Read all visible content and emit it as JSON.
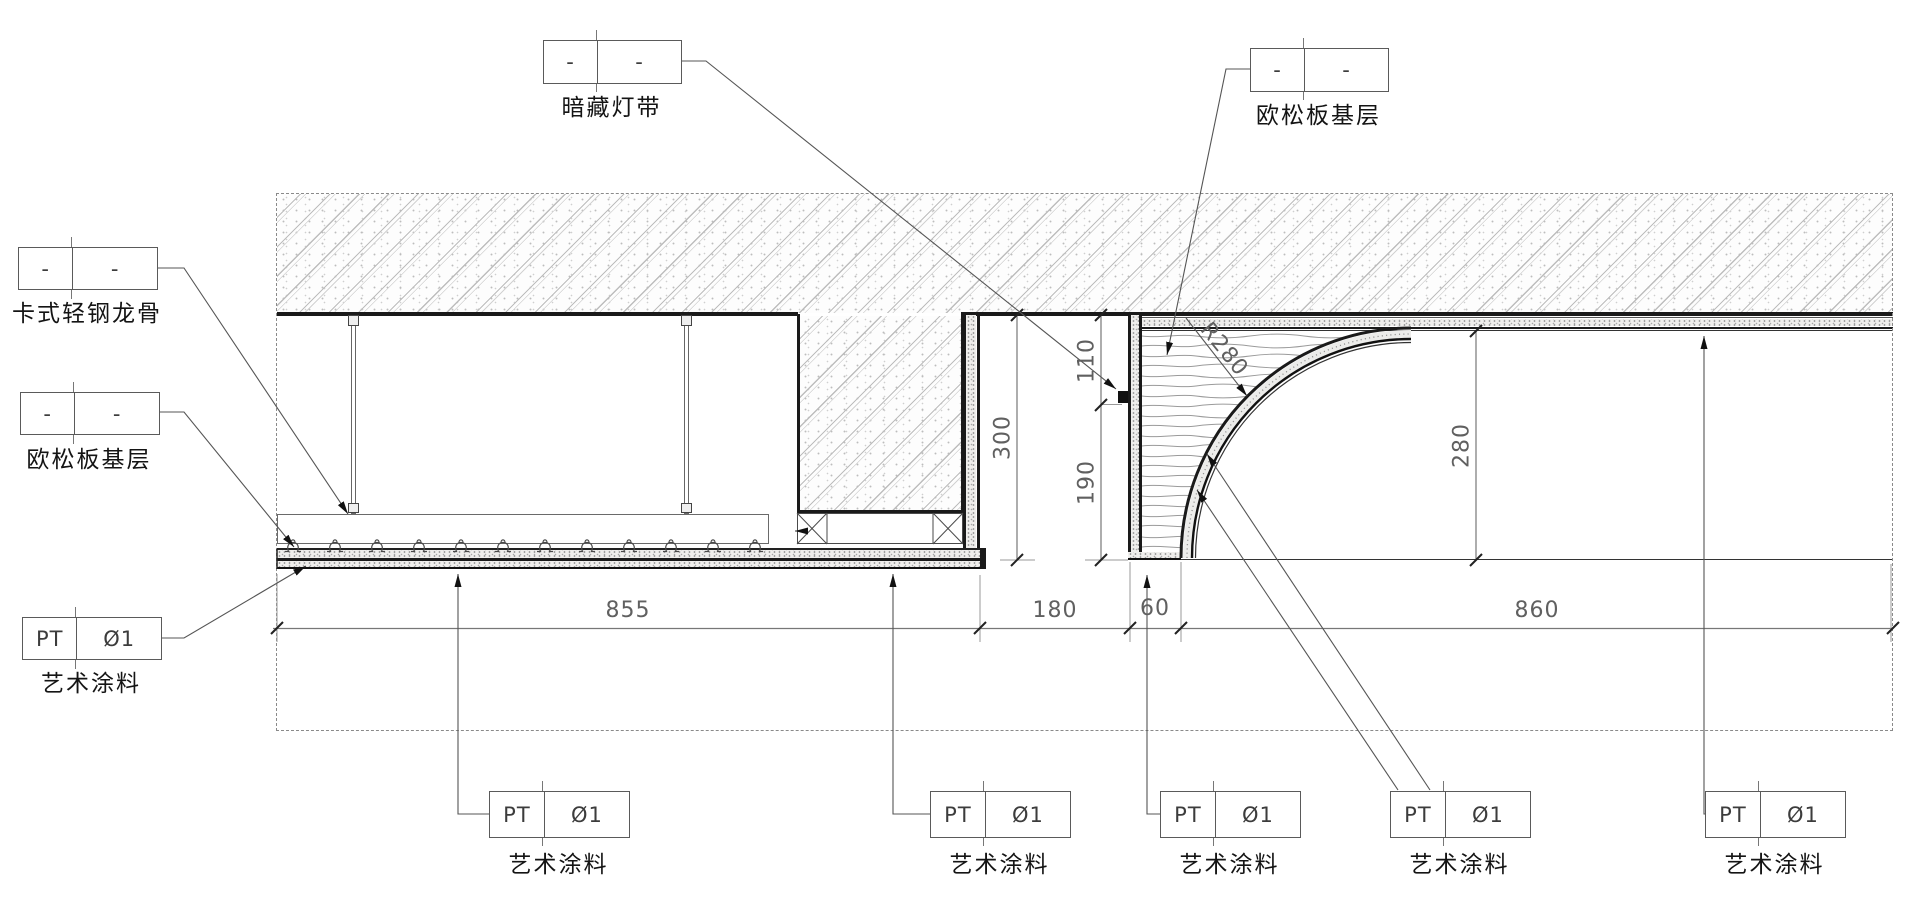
{
  "callouts": {
    "hidden_light": {
      "c1": "-",
      "c2": "-",
      "label": "暗藏灯带"
    },
    "osb_top": {
      "c1": "-",
      "c2": "-",
      "label": "欧松板基层"
    },
    "keel": {
      "c1": "-",
      "c2": "-",
      "label": "卡式轻钢龙骨"
    },
    "osb_left": {
      "c1": "-",
      "c2": "-",
      "label": "欧松板基层"
    },
    "paint_left": {
      "c1": "PT",
      "c2": "Ø1",
      "label": "艺术涂料"
    },
    "paint_bottom": [
      {
        "c1": "PT",
        "c2": "Ø1",
        "label": "艺术涂料"
      },
      {
        "c1": "PT",
        "c2": "Ø1",
        "label": "艺术涂料"
      },
      {
        "c1": "PT",
        "c2": "Ø1",
        "label": "艺术涂料"
      },
      {
        "c1": "PT",
        "c2": "Ø1",
        "label": "艺术涂料"
      },
      {
        "c1": "PT",
        "c2": "Ø1",
        "label": "艺术涂料"
      }
    ]
  },
  "dimensions": {
    "bottom_row": {
      "d855": "855",
      "d180": "180",
      "d60": "60",
      "d860": "860"
    },
    "vertical": {
      "d300": "300",
      "d110": "110",
      "d190": "190",
      "d280": "280"
    },
    "radius": "R280"
  }
}
